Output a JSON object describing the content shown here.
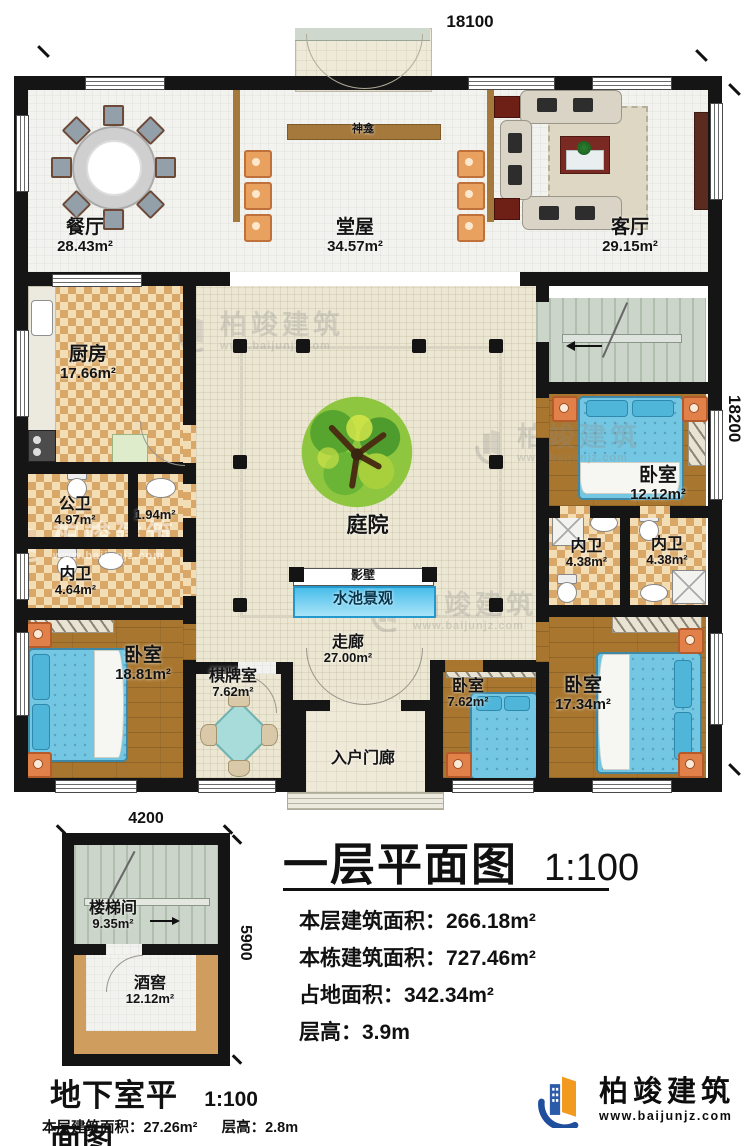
{
  "first_floor": {
    "dim_top": "18100",
    "dim_right": "18200",
    "rooms": {
      "dining": {
        "label": "餐厅",
        "area": "28.43m²"
      },
      "hall": {
        "label": "堂屋",
        "area": "34.57m²"
      },
      "living": {
        "label": "客厅",
        "area": "29.15m²"
      },
      "shrine": {
        "label": "神龛"
      },
      "kitchen": {
        "label": "厨房",
        "area": "17.66m²"
      },
      "public_bath": {
        "label": "公卫",
        "area": "4.97m²"
      },
      "closet": {
        "area": "1.94m²"
      },
      "inner_bath_w": {
        "label": "内卫",
        "area": "4.64m²"
      },
      "bedroom_sw": {
        "label": "卧室",
        "area": "18.81m²"
      },
      "chess": {
        "label": "棋牌室",
        "area": "7.62m²"
      },
      "courtyard": {
        "label": "庭院"
      },
      "screen_wall": {
        "label": "影壁"
      },
      "pool": {
        "label": "水池景观"
      },
      "corridor": {
        "label": "走廊",
        "area": "27.00m²"
      },
      "entry_porch": {
        "label": "入户门廊"
      },
      "bedroom_e": {
        "label": "卧室",
        "area": "12.12m²"
      },
      "inner_bath_e1": {
        "label": "内卫",
        "area": "4.38m²"
      },
      "inner_bath_e2": {
        "label": "内卫",
        "area": "4.38m²"
      },
      "bedroom_se": {
        "label": "卧室",
        "area": "17.34m²"
      },
      "bedroom_s": {
        "label": "卧室",
        "area": "7.62m²"
      }
    }
  },
  "basement": {
    "dim_top": "4200",
    "dim_right": "5900",
    "title": "地下室平面图",
    "scale": "1:100",
    "rooms": {
      "stair_hall": {
        "label": "楼梯间",
        "area": "9.35m²"
      },
      "wine_cellar": {
        "label": "酒窖",
        "area": "12.12m²"
      }
    },
    "stats": [
      {
        "label": "本层建筑面积：",
        "value": "27.26m²"
      },
      {
        "label": "层高：",
        "value": "2.8m"
      }
    ]
  },
  "legend": {
    "title": "一层平面图",
    "scale": "1:100",
    "stats": [
      {
        "label": "本层建筑面积：",
        "value": "266.18m²"
      },
      {
        "label": "本栋建筑面积：",
        "value": "727.46m²"
      },
      {
        "label": "占地面积：",
        "value": "342.34m²"
      },
      {
        "label": "层高：",
        "value": "3.9m"
      }
    ]
  },
  "logo": {
    "name": "柏竣建筑",
    "website": "www.baijunjz.com"
  },
  "watermark": {
    "name": "柏竣建筑",
    "website": "www.baijunjz.com"
  }
}
